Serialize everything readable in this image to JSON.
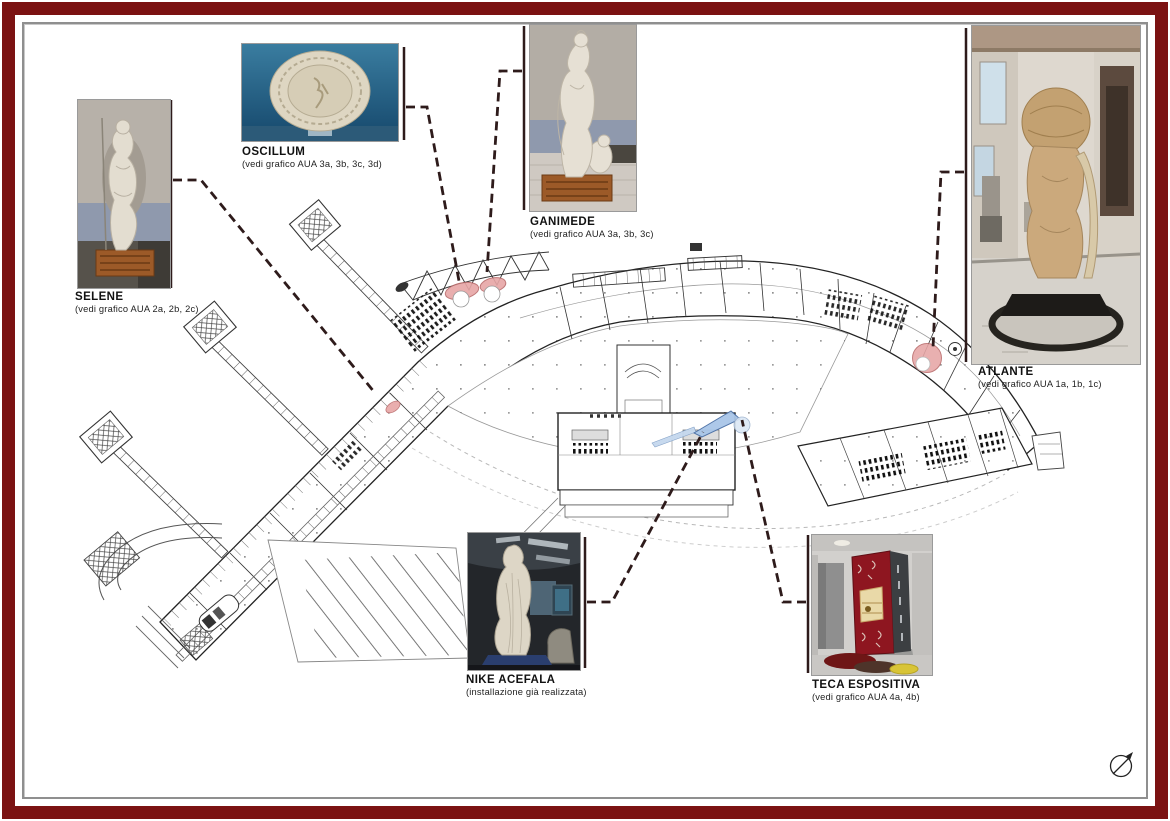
{
  "callouts": {
    "selene": {
      "title": "SELENE",
      "note": "(vedi grafico AUA 2a, 2b, 2c)"
    },
    "oscillum": {
      "title": "OSCILLUM",
      "note": "(vedi grafico AUA 3a, 3b, 3c, 3d)"
    },
    "ganimede": {
      "title": "GANIMEDE",
      "note": "(vedi grafico AUA 3a, 3b, 3c)"
    },
    "atlante": {
      "title": "ATLANTE",
      "note": "(vedi grafico AUA 1a, 1b, 1c)"
    },
    "nike": {
      "title": "NIKE ACEFALA",
      "note": "(installazione già realizzata)"
    },
    "teca": {
      "title": "TECA ESPOSITIVA",
      "note": "(vedi grafico AUA 4a, 4b)"
    }
  },
  "icons": {
    "north_arrow": "north-compass-arrow"
  },
  "colors": {
    "frame": "#7b1212",
    "leader": "#2e1b1b",
    "highlight_pink": "#e7a6a6",
    "highlight_blue": "#a9c6e8",
    "plan_line": "#222222"
  }
}
